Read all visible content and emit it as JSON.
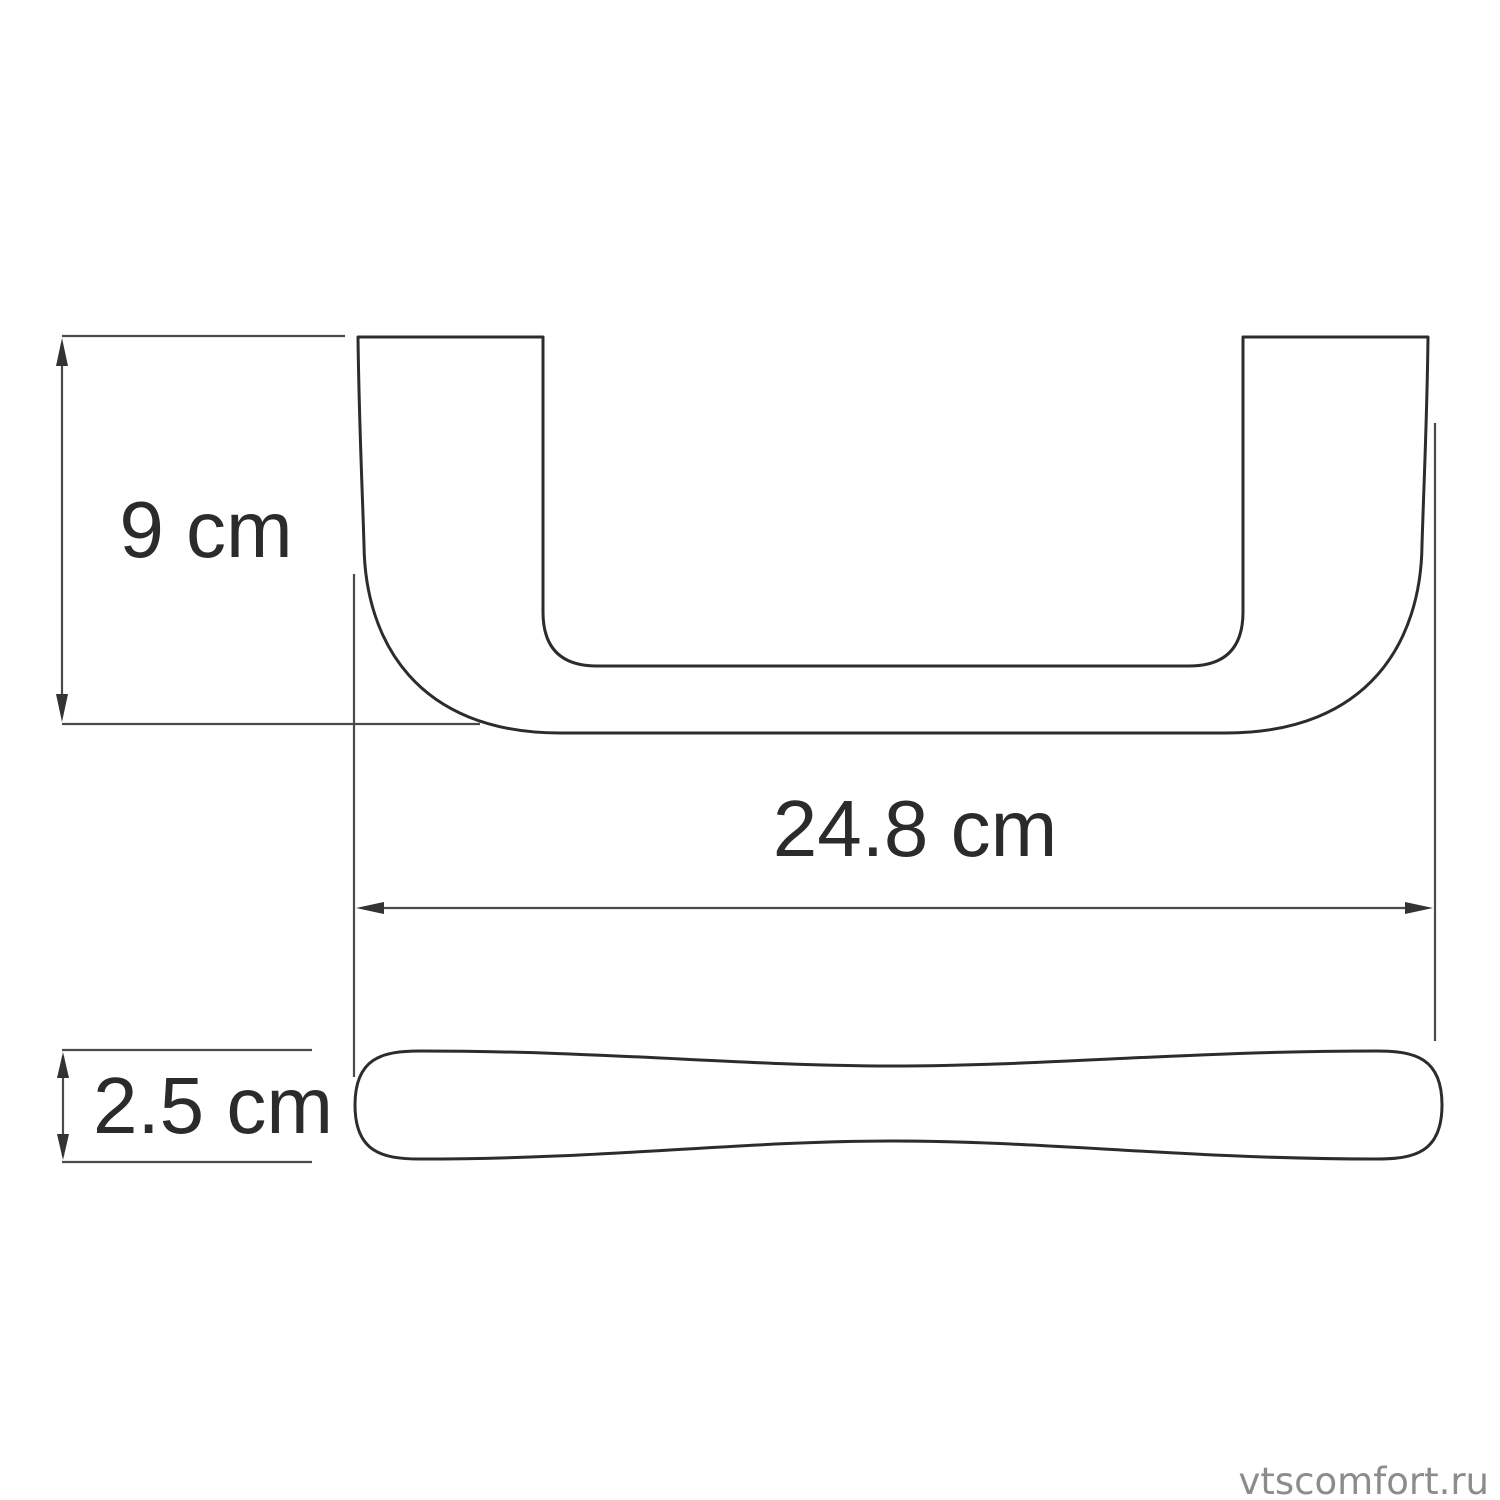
{
  "diagram": {
    "title": "handle-dimension-drawing",
    "views": {
      "front_view": "u-shaped handle front profile",
      "bottom_view": "handle bar bottom profile"
    },
    "dimensions": {
      "height": {
        "label": "9 cm"
      },
      "width": {
        "label": "24.8 cm"
      },
      "depth": {
        "label": "2.5 cm"
      }
    },
    "watermark": {
      "text": "vtscomfort.ru"
    },
    "colors": {
      "outline": "#2c2c2c",
      "dimension": "#4a4a4a",
      "arrow": "#333333",
      "label_text": "#2b2b2b",
      "watermark_text": "#8c8c8c",
      "background": "#ffffff"
    }
  }
}
